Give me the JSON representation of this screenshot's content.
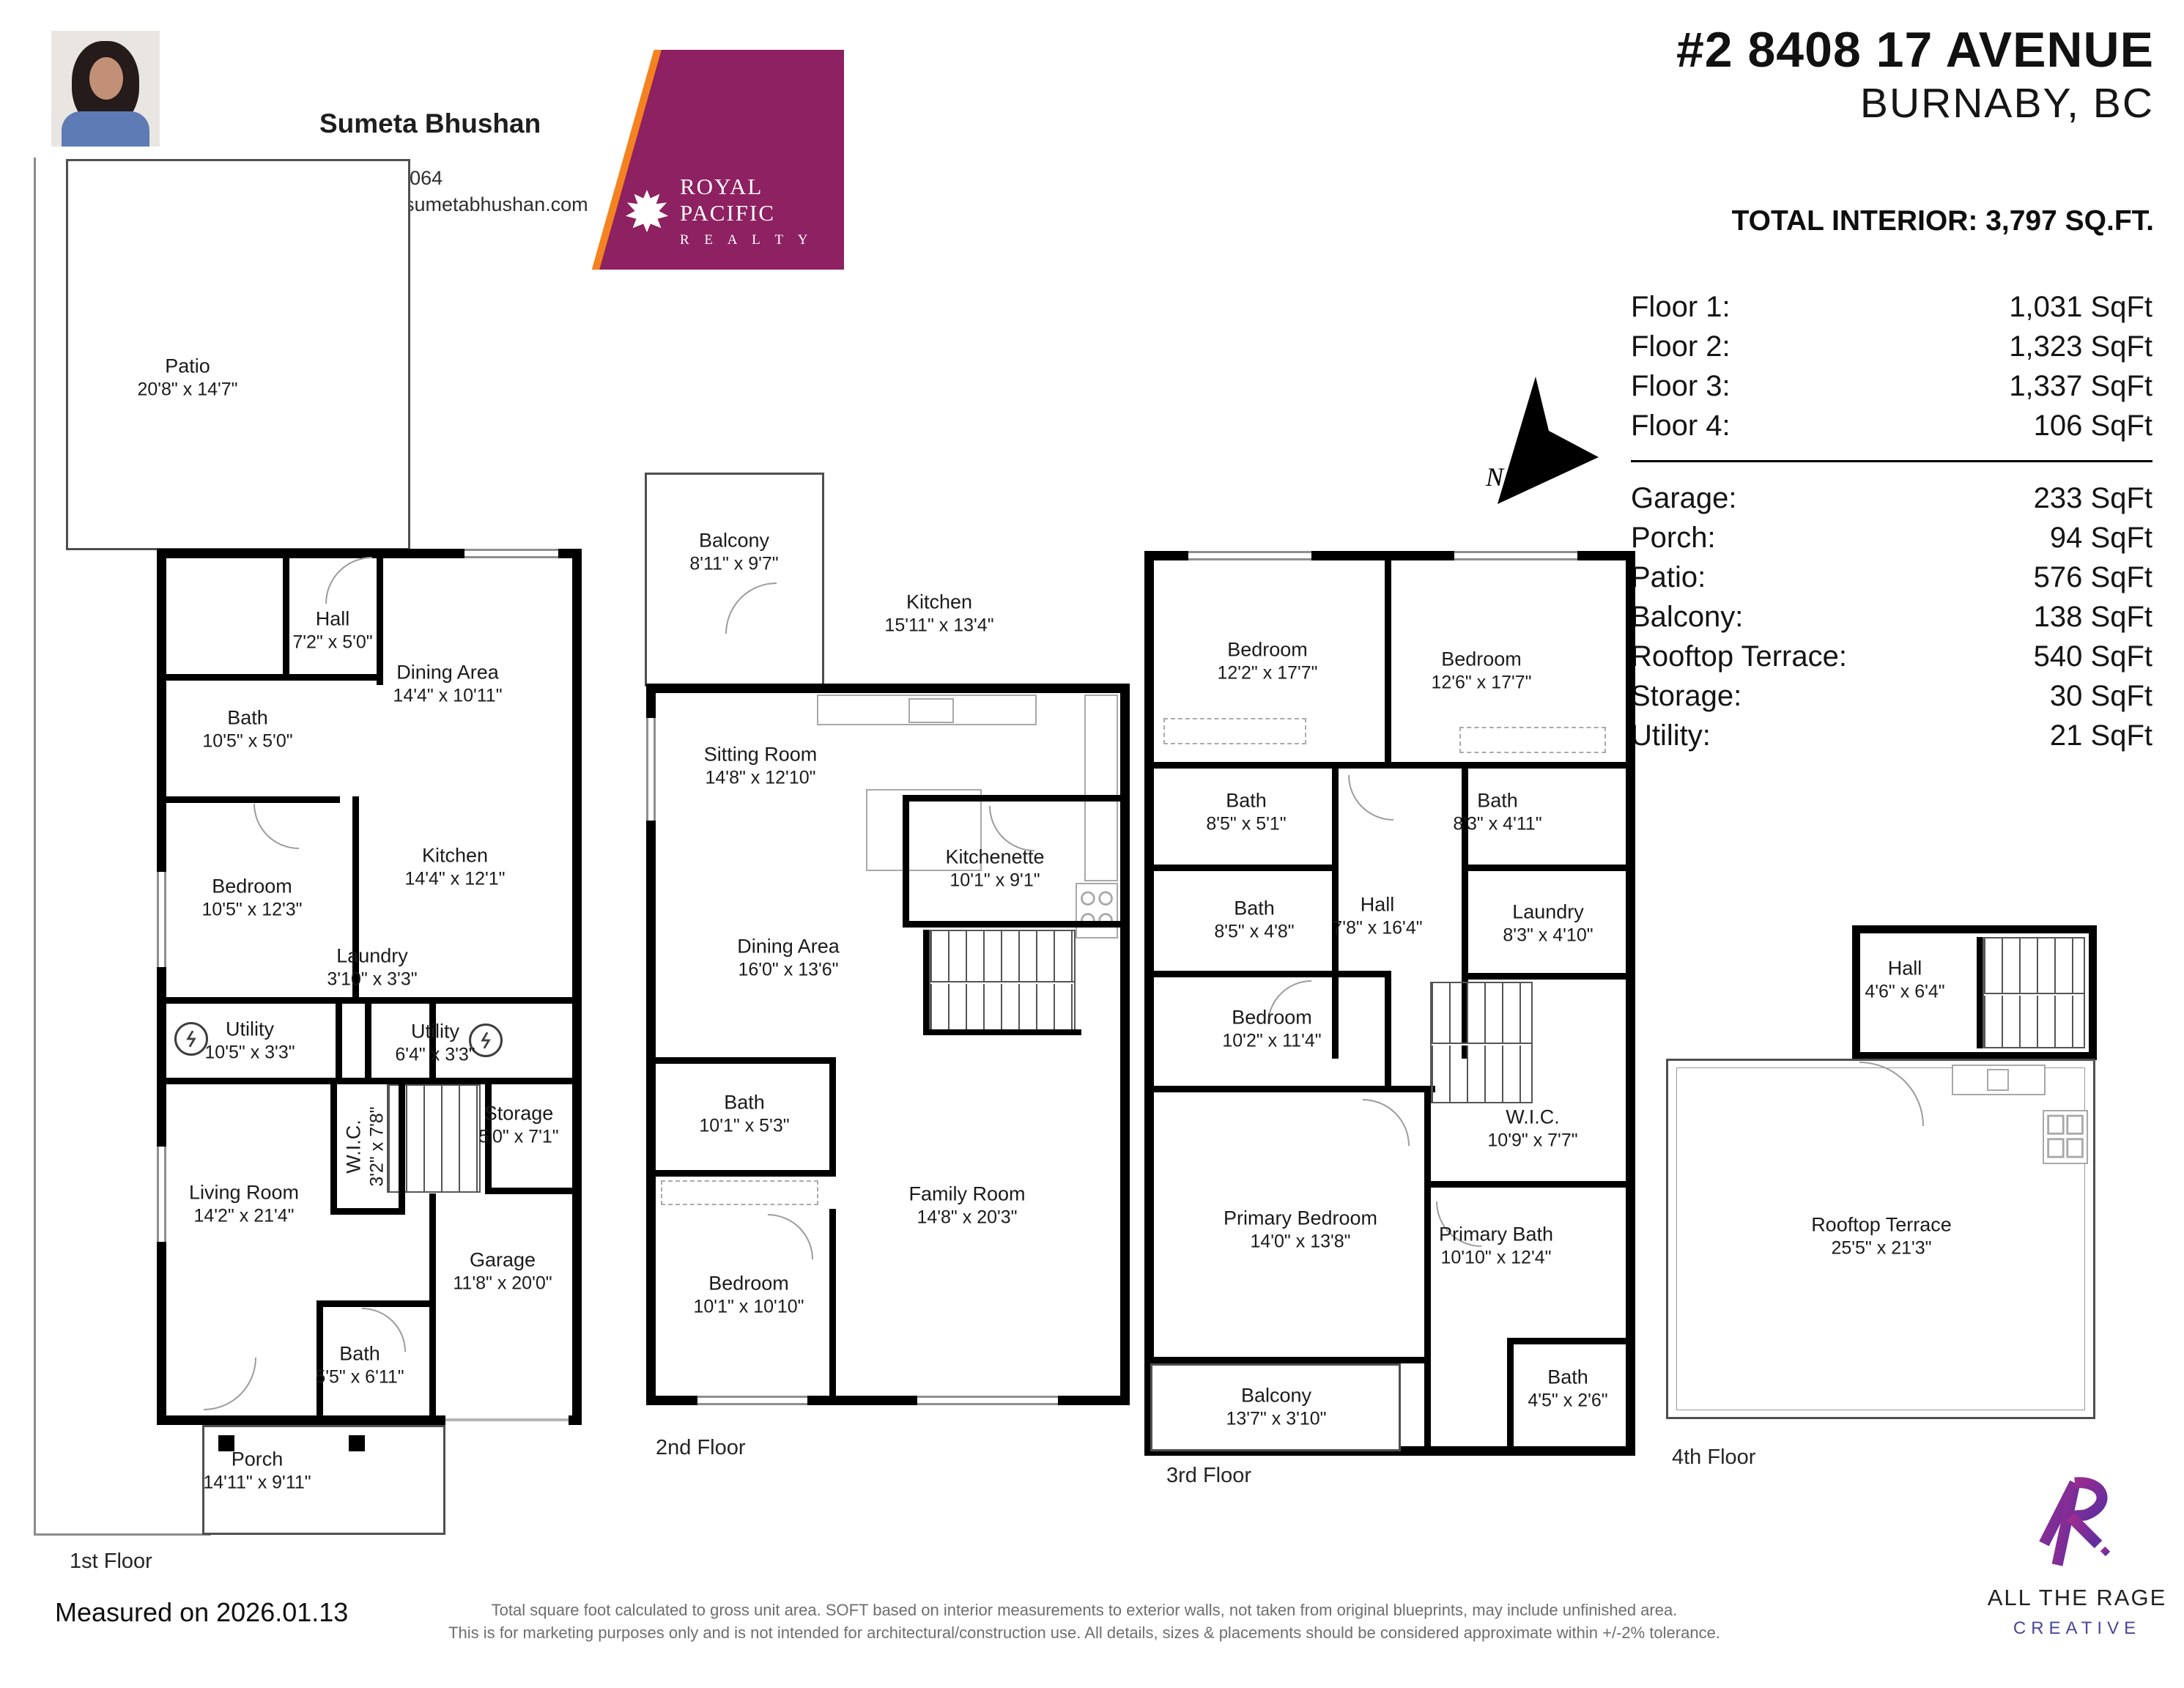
{
  "agent": {
    "name": "Sumeta Bhushan",
    "phone": "778-919-8064",
    "email": "sumeta@sumetabhushan.com"
  },
  "brokerage": {
    "name": "ROYAL PACIFIC",
    "subtitle": "R E A L T Y"
  },
  "listing": {
    "address_line1": "#2 8408 17 AVENUE",
    "address_line2": "BURNABY, BC",
    "total_interior": "TOTAL INTERIOR: 3,797 SQ.FT."
  },
  "summary": {
    "floors": [
      {
        "label": "Floor 1:",
        "value": "1,031 SqFt"
      },
      {
        "label": "Floor 2:",
        "value": "1,323 SqFt"
      },
      {
        "label": "Floor 3:",
        "value": "1,337 SqFt"
      },
      {
        "label": "Floor 4:",
        "value": "106 SqFt"
      }
    ],
    "areas": [
      {
        "label": "Garage:",
        "value": "233 SqFt"
      },
      {
        "label": "Porch:",
        "value": "94 SqFt"
      },
      {
        "label": "Patio:",
        "value": "576 SqFt"
      },
      {
        "label": "Balcony:",
        "value": "138 SqFt"
      },
      {
        "label": "Rooftop Terrace:",
        "value": "540 SqFt"
      },
      {
        "label": "Storage:",
        "value": "30 SqFt"
      },
      {
        "label": "Utility:",
        "value": "21 SqFt"
      }
    ]
  },
  "compass": {
    "label": "N"
  },
  "floors": [
    {
      "caption": "1st Floor",
      "rooms": [
        {
          "name": "Patio",
          "dims": "20'8\" x 14'7\""
        },
        {
          "name": "Hall",
          "dims": "7'2\" x 5'0\""
        },
        {
          "name": "Dining Area",
          "dims": "14'4\" x 10'11\""
        },
        {
          "name": "Bath",
          "dims": "10'5\" x 5'0\""
        },
        {
          "name": "Bedroom",
          "dims": "10'5\" x 12'3\""
        },
        {
          "name": "Kitchen",
          "dims": "14'4\" x 12'1\""
        },
        {
          "name": "Laundry",
          "dims": "3'10\" x 3'3\""
        },
        {
          "name": "Utility",
          "dims": "10'5\" x 3'3\""
        },
        {
          "name": "Utility",
          "dims": "6'4\" x 3'3\""
        },
        {
          "name": "Storage",
          "dims": "5'0\" x 7'1\""
        },
        {
          "name": "W.I.C.",
          "dims": "3'2\" x 7'8\""
        },
        {
          "name": "Living Room",
          "dims": "14'2\" x 21'4\""
        },
        {
          "name": "Garage",
          "dims": "11'8\" x 20'0\""
        },
        {
          "name": "Bath",
          "dims": "5'5\" x 6'11\""
        },
        {
          "name": "Porch",
          "dims": "14'11\" x 9'11\""
        }
      ]
    },
    {
      "caption": "2nd Floor",
      "rooms": [
        {
          "name": "Balcony",
          "dims": "8'11\" x 9'7\""
        },
        {
          "name": "Kitchen",
          "dims": "15'11\" x 13'4\""
        },
        {
          "name": "Sitting Room",
          "dims": "14'8\" x 12'10\""
        },
        {
          "name": "Kitchenette",
          "dims": "10'1\" x 9'1\""
        },
        {
          "name": "Dining Area",
          "dims": "16'0\" x 13'6\""
        },
        {
          "name": "Bath",
          "dims": "10'1\" x 5'3\""
        },
        {
          "name": "Family Room",
          "dims": "14'8\" x 20'3\""
        },
        {
          "name": "Bedroom",
          "dims": "10'1\" x 10'10\""
        }
      ]
    },
    {
      "caption": "3rd Floor",
      "rooms": [
        {
          "name": "Bedroom",
          "dims": "12'2\" x 17'7\""
        },
        {
          "name": "Bedroom",
          "dims": "12'6\" x 17'7\""
        },
        {
          "name": "Bath",
          "dims": "8'5\" x 5'1\""
        },
        {
          "name": "Bath",
          "dims": "8'3\" x 4'11\""
        },
        {
          "name": "Bath",
          "dims": "8'5\" x 4'8\""
        },
        {
          "name": "Hall",
          "dims": "7'8\" x 16'4\""
        },
        {
          "name": "Laundry",
          "dims": "8'3\" x 4'10\""
        },
        {
          "name": "Bedroom",
          "dims": "10'2\" x 11'4\""
        },
        {
          "name": "W.I.C.",
          "dims": "10'9\" x 7'7\""
        },
        {
          "name": "Primary Bedroom",
          "dims": "14'0\" x 13'8\""
        },
        {
          "name": "Primary Bath",
          "dims": "10'10\" x 12'4\""
        },
        {
          "name": "Balcony",
          "dims": "13'7\" x 3'10\""
        },
        {
          "name": "Bath",
          "dims": "4'5\" x 2'6\""
        }
      ]
    },
    {
      "caption": "4th Floor",
      "rooms": [
        {
          "name": "Hall",
          "dims": "4'6\" x 6'4\""
        },
        {
          "name": "Rooftop Terrace",
          "dims": "25'5\" x 21'3\""
        }
      ]
    }
  ],
  "footer": {
    "measured": "Measured on 2026.01.13",
    "disclaimer_line1": "Total square foot calculated to gross unit area. SOFT based on interior measurements to exterior walls, not taken from original blueprints, may include unfinished area.",
    "disclaimer_line2": "This is for marketing purposes only and is not intended for architectural/construction use. All details, sizes & placements should be considered approximate within +/-2% tolerance."
  },
  "credit": {
    "studio": "ALL THE RAGE",
    "tagline": "CREATIVE"
  }
}
